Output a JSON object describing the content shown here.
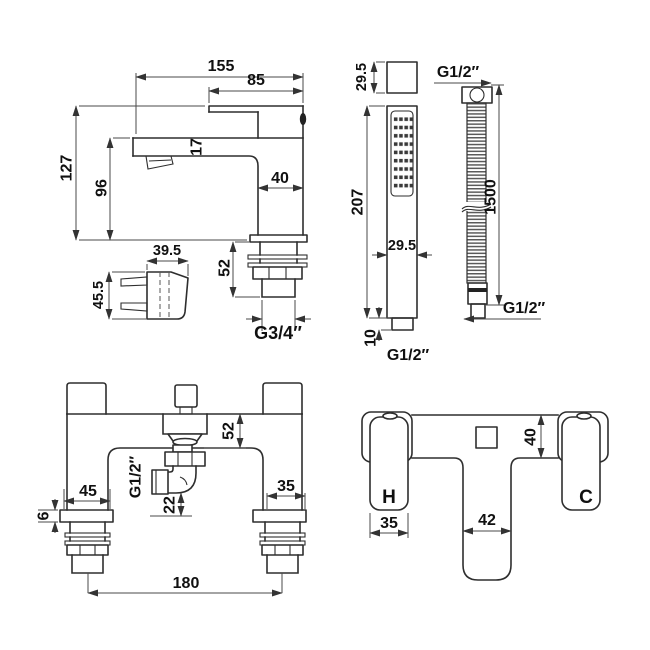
{
  "colors": {
    "line": "#2e2e2e",
    "dimension": "#4a4a4a",
    "text": "#101010",
    "background": "#ffffff"
  },
  "tap_side_view": {
    "total_reach_mm": "155",
    "handle_length_mm": "85",
    "overall_height_mm": "127",
    "spout_height_mm": "96",
    "spout_thickness_mm": "17",
    "body_width_mm": "40",
    "shank_length_mm": "52",
    "shank_thread": "G3/4″",
    "handle_profile_width_mm": "39.5",
    "handle_profile_height_mm": "45.5"
  },
  "shower_handset": {
    "head_depth_mm": "29.5",
    "body_length_mm": "207",
    "body_width_mm": "29.5",
    "connector_length_mm": "10",
    "connector_thread": "G1/2″"
  },
  "shower_hose": {
    "top_thread": "G1/2″",
    "length_mm": "1500",
    "bottom_thread": "G1/2″"
  },
  "mixer_front_view": {
    "body_height_mm": "52",
    "handset_outlet_thread": "G1/2″",
    "outlet_clearance_mm": "22",
    "left_base_width_mm": "45",
    "base_plate_thickness_mm": "6",
    "right_leg_width_mm": "35",
    "inlet_centres_mm": "180"
  },
  "mixer_top_view": {
    "body_depth_mm": "40",
    "handle_width_mm": "35",
    "spout_width_mm": "42",
    "hot_label": "H",
    "cold_label": "C"
  }
}
